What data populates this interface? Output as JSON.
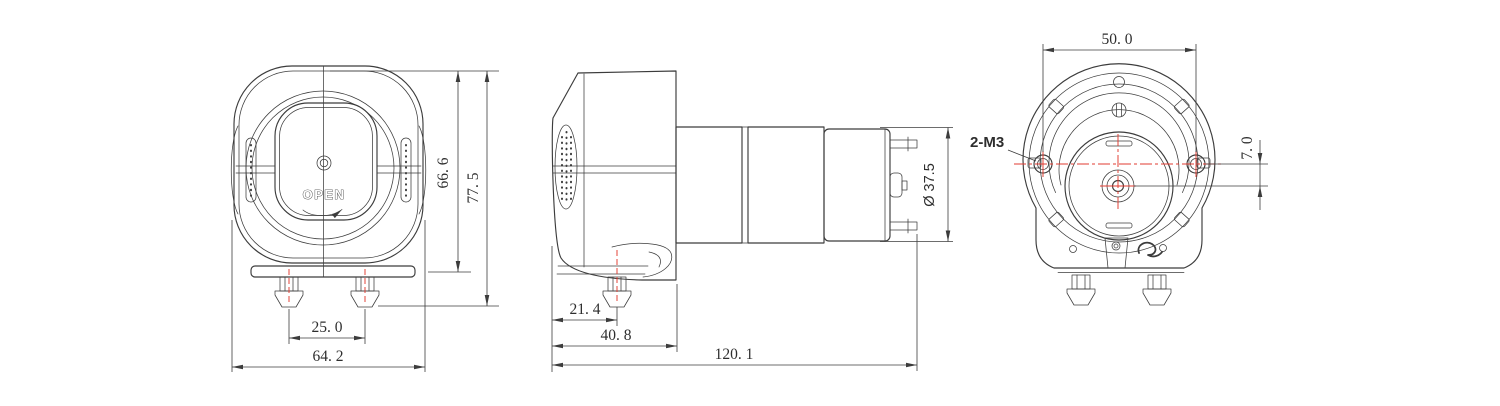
{
  "colors": {
    "line_color": "#3c3c3c",
    "centerline_color": "#e23b30",
    "text_color": "#2e2e2e",
    "background": "#ffffff"
  },
  "views": {
    "front": {
      "open_label": "OPEN",
      "dims": {
        "body_height": "66. 6",
        "overall_height": "77. 5",
        "port_spacing": "25. 0",
        "overall_width": "64. 2"
      }
    },
    "side": {
      "dims": {
        "port_offset": "21. 4",
        "head_depth": "40. 8",
        "overall_length": "120. 1",
        "motor_diameter": "Ø 37.5"
      }
    },
    "back": {
      "thread_callout": "2-M3",
      "dims": {
        "mount_hole_spacing": "50. 0",
        "shaft_offset": "7. 0"
      }
    }
  }
}
